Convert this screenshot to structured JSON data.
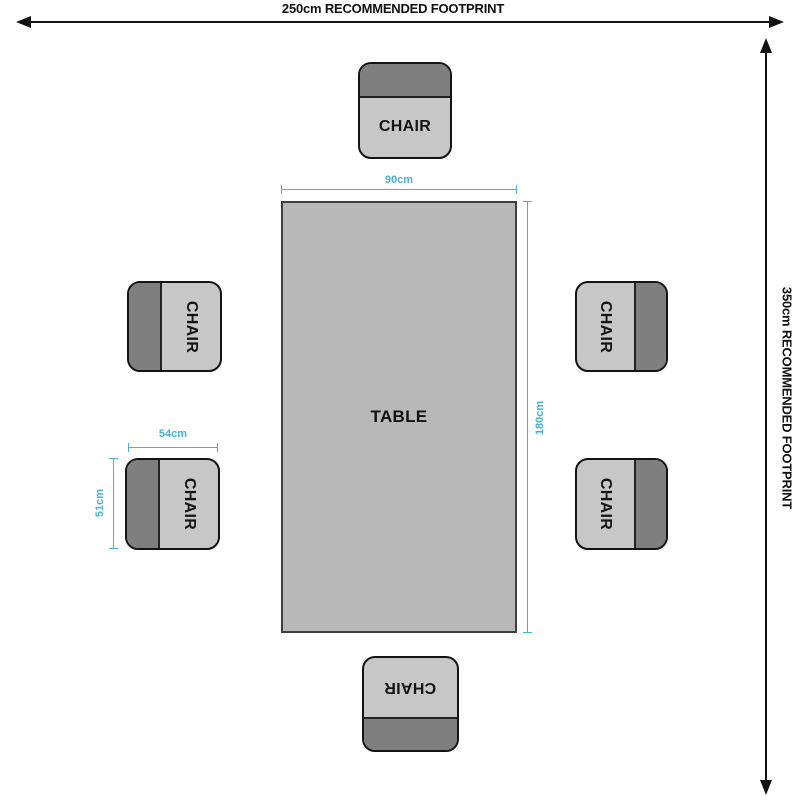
{
  "diagram": {
    "footprint": {
      "top_label": "250cm RECOMMENDED FOOTPRINT",
      "side_label": "350cm RECOMMENDED FOOTPRINT"
    },
    "table": {
      "label": "TABLE",
      "width": "90cm",
      "depth": "180cm"
    },
    "chair": {
      "label": "CHAIR",
      "width": "54cm",
      "depth": "51cm",
      "count": 6
    }
  },
  "colors": {
    "accent": "#45b1da",
    "table-fill": "#b8b8b8",
    "seat-fill": "#c7c7c7",
    "backrest-fill": "#7f7f7f",
    "line": "#111111"
  }
}
